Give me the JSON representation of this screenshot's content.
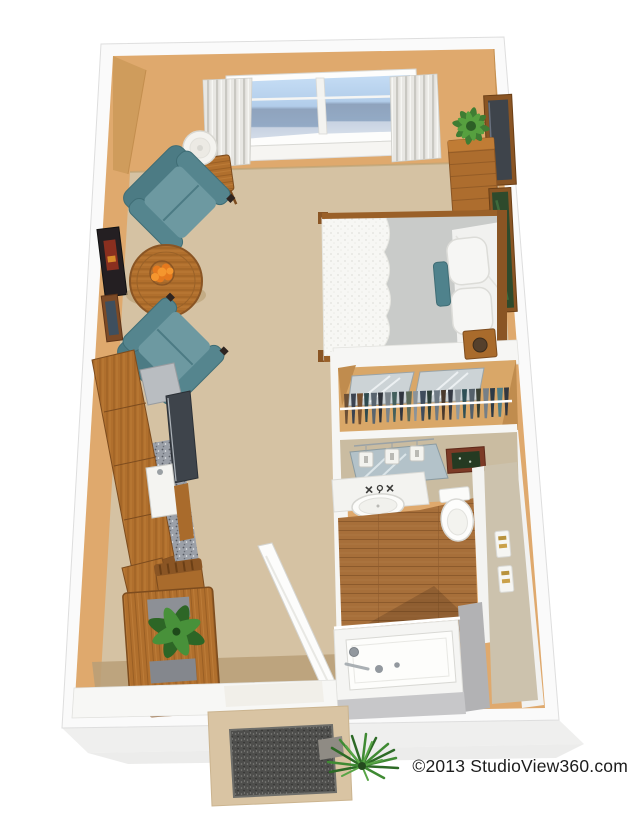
{
  "watermark": {
    "copyright": "©2013 StudioView360.com"
  },
  "palette": {
    "text": "#1c1c1c",
    "wallTan": "#dfa96d",
    "wallShade": "#c98f4f",
    "outerWall": "#fafafa",
    "carpet": "#d5c2a3",
    "carpetShade": "#b89f78",
    "wood": "#b06f2d",
    "woodDark": "#7d4c1e",
    "tealDark": "#4c7b84",
    "tealLight": "#6d99a1",
    "glassTop": "#bdd7f2",
    "glassBottom": "#8fa3bd",
    "curtain": "#e8e7e3",
    "counterSpeckle": "#9ba0a8",
    "appliance": "#b9bdc1",
    "tvGray": "#3e444b",
    "linen": "#f6f6f4",
    "sheetGray": "#c9cbc9",
    "plankWood": "#a76f3a",
    "plantGreen": "#3f8a33",
    "matGray": "#4e4e4c",
    "hallwayTan": "#ccc2ad",
    "tubWallGray": "#b2b2b4",
    "shadow": "#e6e6e4"
  },
  "scene": {
    "type": "apartment-3d-floor-plan",
    "rooms": [
      {
        "name": "living-area",
        "items": [
          "armchair",
          "armchair",
          "round-coffee-table",
          "fruit-bowl",
          "side-table",
          "table-lamp",
          "wall-art",
          "wall-art",
          "picture-window",
          "curtains"
        ]
      },
      {
        "name": "sleeping-area",
        "items": [
          "bed",
          "comforter",
          "pillows",
          "accent-pillow",
          "headboard",
          "bedside-table",
          "wall-tv",
          "plant-stand",
          "potted-plant",
          "wall-art-green"
        ]
      },
      {
        "name": "closet",
        "items": [
          "hanging-clothes",
          "clothes-rod",
          "mirrored-doors"
        ]
      },
      {
        "name": "bathroom",
        "items": [
          "vanity-mirror",
          "vanity-lights",
          "wall-art",
          "sink",
          "faucet",
          "toilet",
          "wood-floor",
          "towel-rack",
          "bathtub"
        ]
      },
      {
        "name": "kitchenette",
        "items": [
          "upper-cabinets",
          "speckled-countertop",
          "kitchen-sink",
          "refrigerator",
          "flat-tv"
        ]
      },
      {
        "name": "dining-area",
        "items": [
          "dining-table",
          "dining-chair",
          "dining-chair",
          "placemat",
          "placemat",
          "houseplant"
        ]
      },
      {
        "name": "entry",
        "items": [
          "entry-door",
          "threshold",
          "stoop",
          "doormat",
          "outdoor-plant"
        ]
      }
    ],
    "closet_clothes_colors": [
      "#6b4f35",
      "#3c4350",
      "#76502f",
      "#2f4a4e",
      "#59646e",
      "#2e3239",
      "#7b848b",
      "#44605d",
      "#31363f",
      "#5d6b5a",
      "#8a939a",
      "#3f4c5c",
      "#2c3e38",
      "#6e7a84",
      "#4a3a2c",
      "#353a44",
      "#8f989e",
      "#2f5056",
      "#55616b",
      "#3a4034",
      "#767f87",
      "#2d3a46",
      "#4f7d86",
      "#33383f"
    ]
  }
}
